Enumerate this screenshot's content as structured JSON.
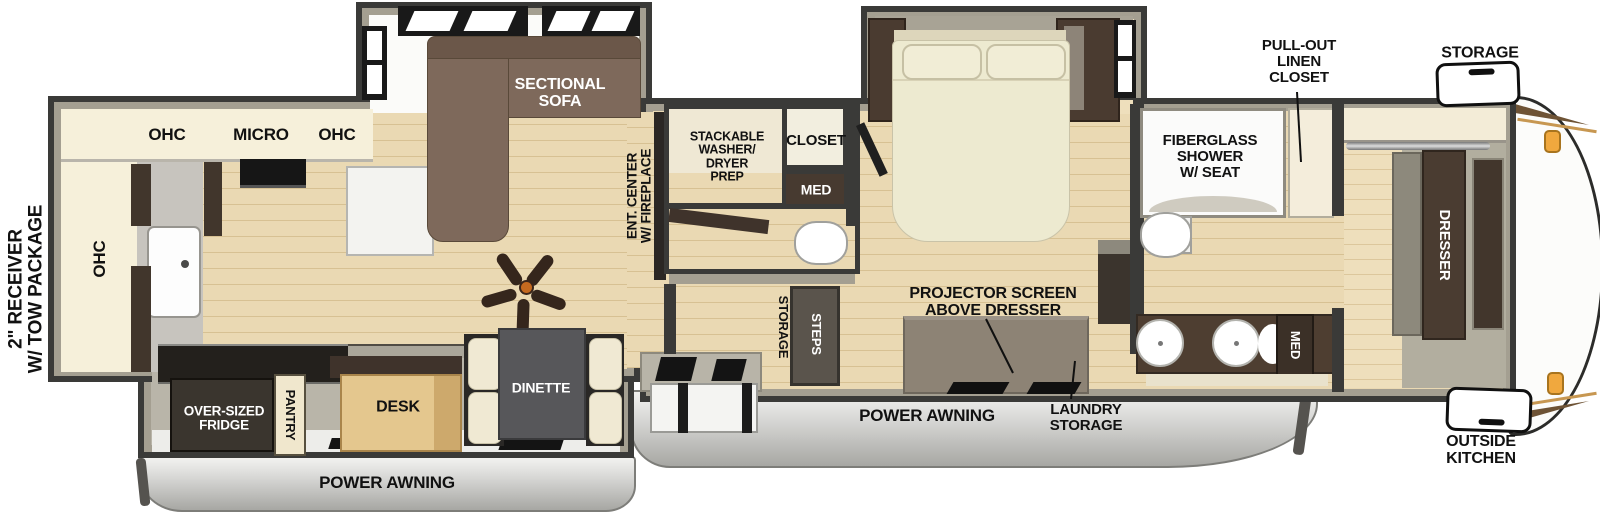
{
  "colors": {
    "wall": "#3a3a38",
    "wall_band": "#a49f91",
    "floor_wood": "#ead9b3",
    "counter_cream": "#f6f0da",
    "sofa_brown": "#7e695b",
    "bed_cream": "#edead0",
    "cabinet_dark": "#4a3b30",
    "marker_amber": "#f0a83e"
  },
  "exterior": {
    "hitch": "2\" RECEIVER\nW/ TOW PACKAGE",
    "storage_front": "STORAGE",
    "outside_kitchen": "OUTSIDE\nKITCHEN",
    "power_awning_rear": "POWER AWNING",
    "power_awning_main": "POWER AWNING"
  },
  "kitchen": {
    "ohc_left": "OHC",
    "micro": "MICRO",
    "ohc_right": "OHC",
    "ohc_side": "OHC"
  },
  "living": {
    "sectional_sofa": "SECTIONAL\nSOFA",
    "ent_center": "ENT. CENTER\nW/ FIREPLACE"
  },
  "utility": {
    "washer_prep": "STACKABLE\nWASHER/\nDRYER\nPREP",
    "closet": "CLOSET",
    "med": "MED",
    "storage": "STORAGE",
    "steps": "STEPS"
  },
  "bedroom": {
    "projector": "PROJECTOR SCREEN\nABOVE DRESSER",
    "laundry_storage": "LAUNDRY\nSTORAGE"
  },
  "bath": {
    "shower": "FIBERGLASS\nSHOWER\nW/ SEAT",
    "linen": "PULL-OUT\nLINEN\nCLOSET",
    "med": "MED"
  },
  "front_closet": {
    "dresser": "DRESSER"
  },
  "galley_slide": {
    "fridge": "OVER-SIZED\nFRIDGE",
    "pantry": "PANTRY",
    "desk": "DESK",
    "dinette": "DINETTE"
  }
}
